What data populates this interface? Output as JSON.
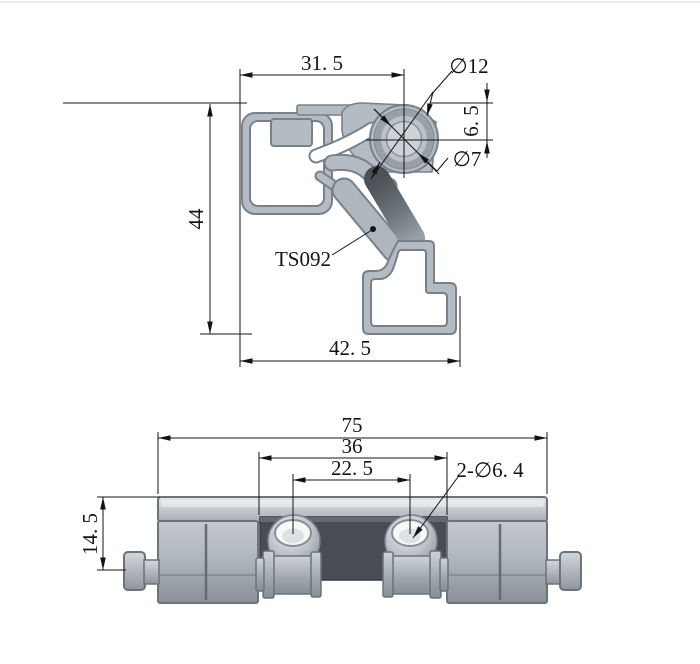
{
  "drawing": {
    "part_number": "TS092",
    "colors": {
      "line": "#141414",
      "profile_fill": "#b4bbc2",
      "profile_outline": "#78818a",
      "dark_accent": "#4b5157",
      "recess_plate": "#474d53"
    },
    "profile_view": {
      "dim_top_width": "31. 5",
      "dim_outer_diameter": "∅12",
      "dim_center_offset": "6. 5",
      "dim_inner_diameter": "∅7",
      "dim_height": "44",
      "dim_bottom_width": "42. 5",
      "part_label": "TS092"
    },
    "front_view": {
      "dim_overall_width": "75",
      "dim_slot_width": "36",
      "dim_hole_spacing": "22. 5",
      "dim_height": "14. 5",
      "dim_holes": "2-∅6. 4"
    }
  }
}
